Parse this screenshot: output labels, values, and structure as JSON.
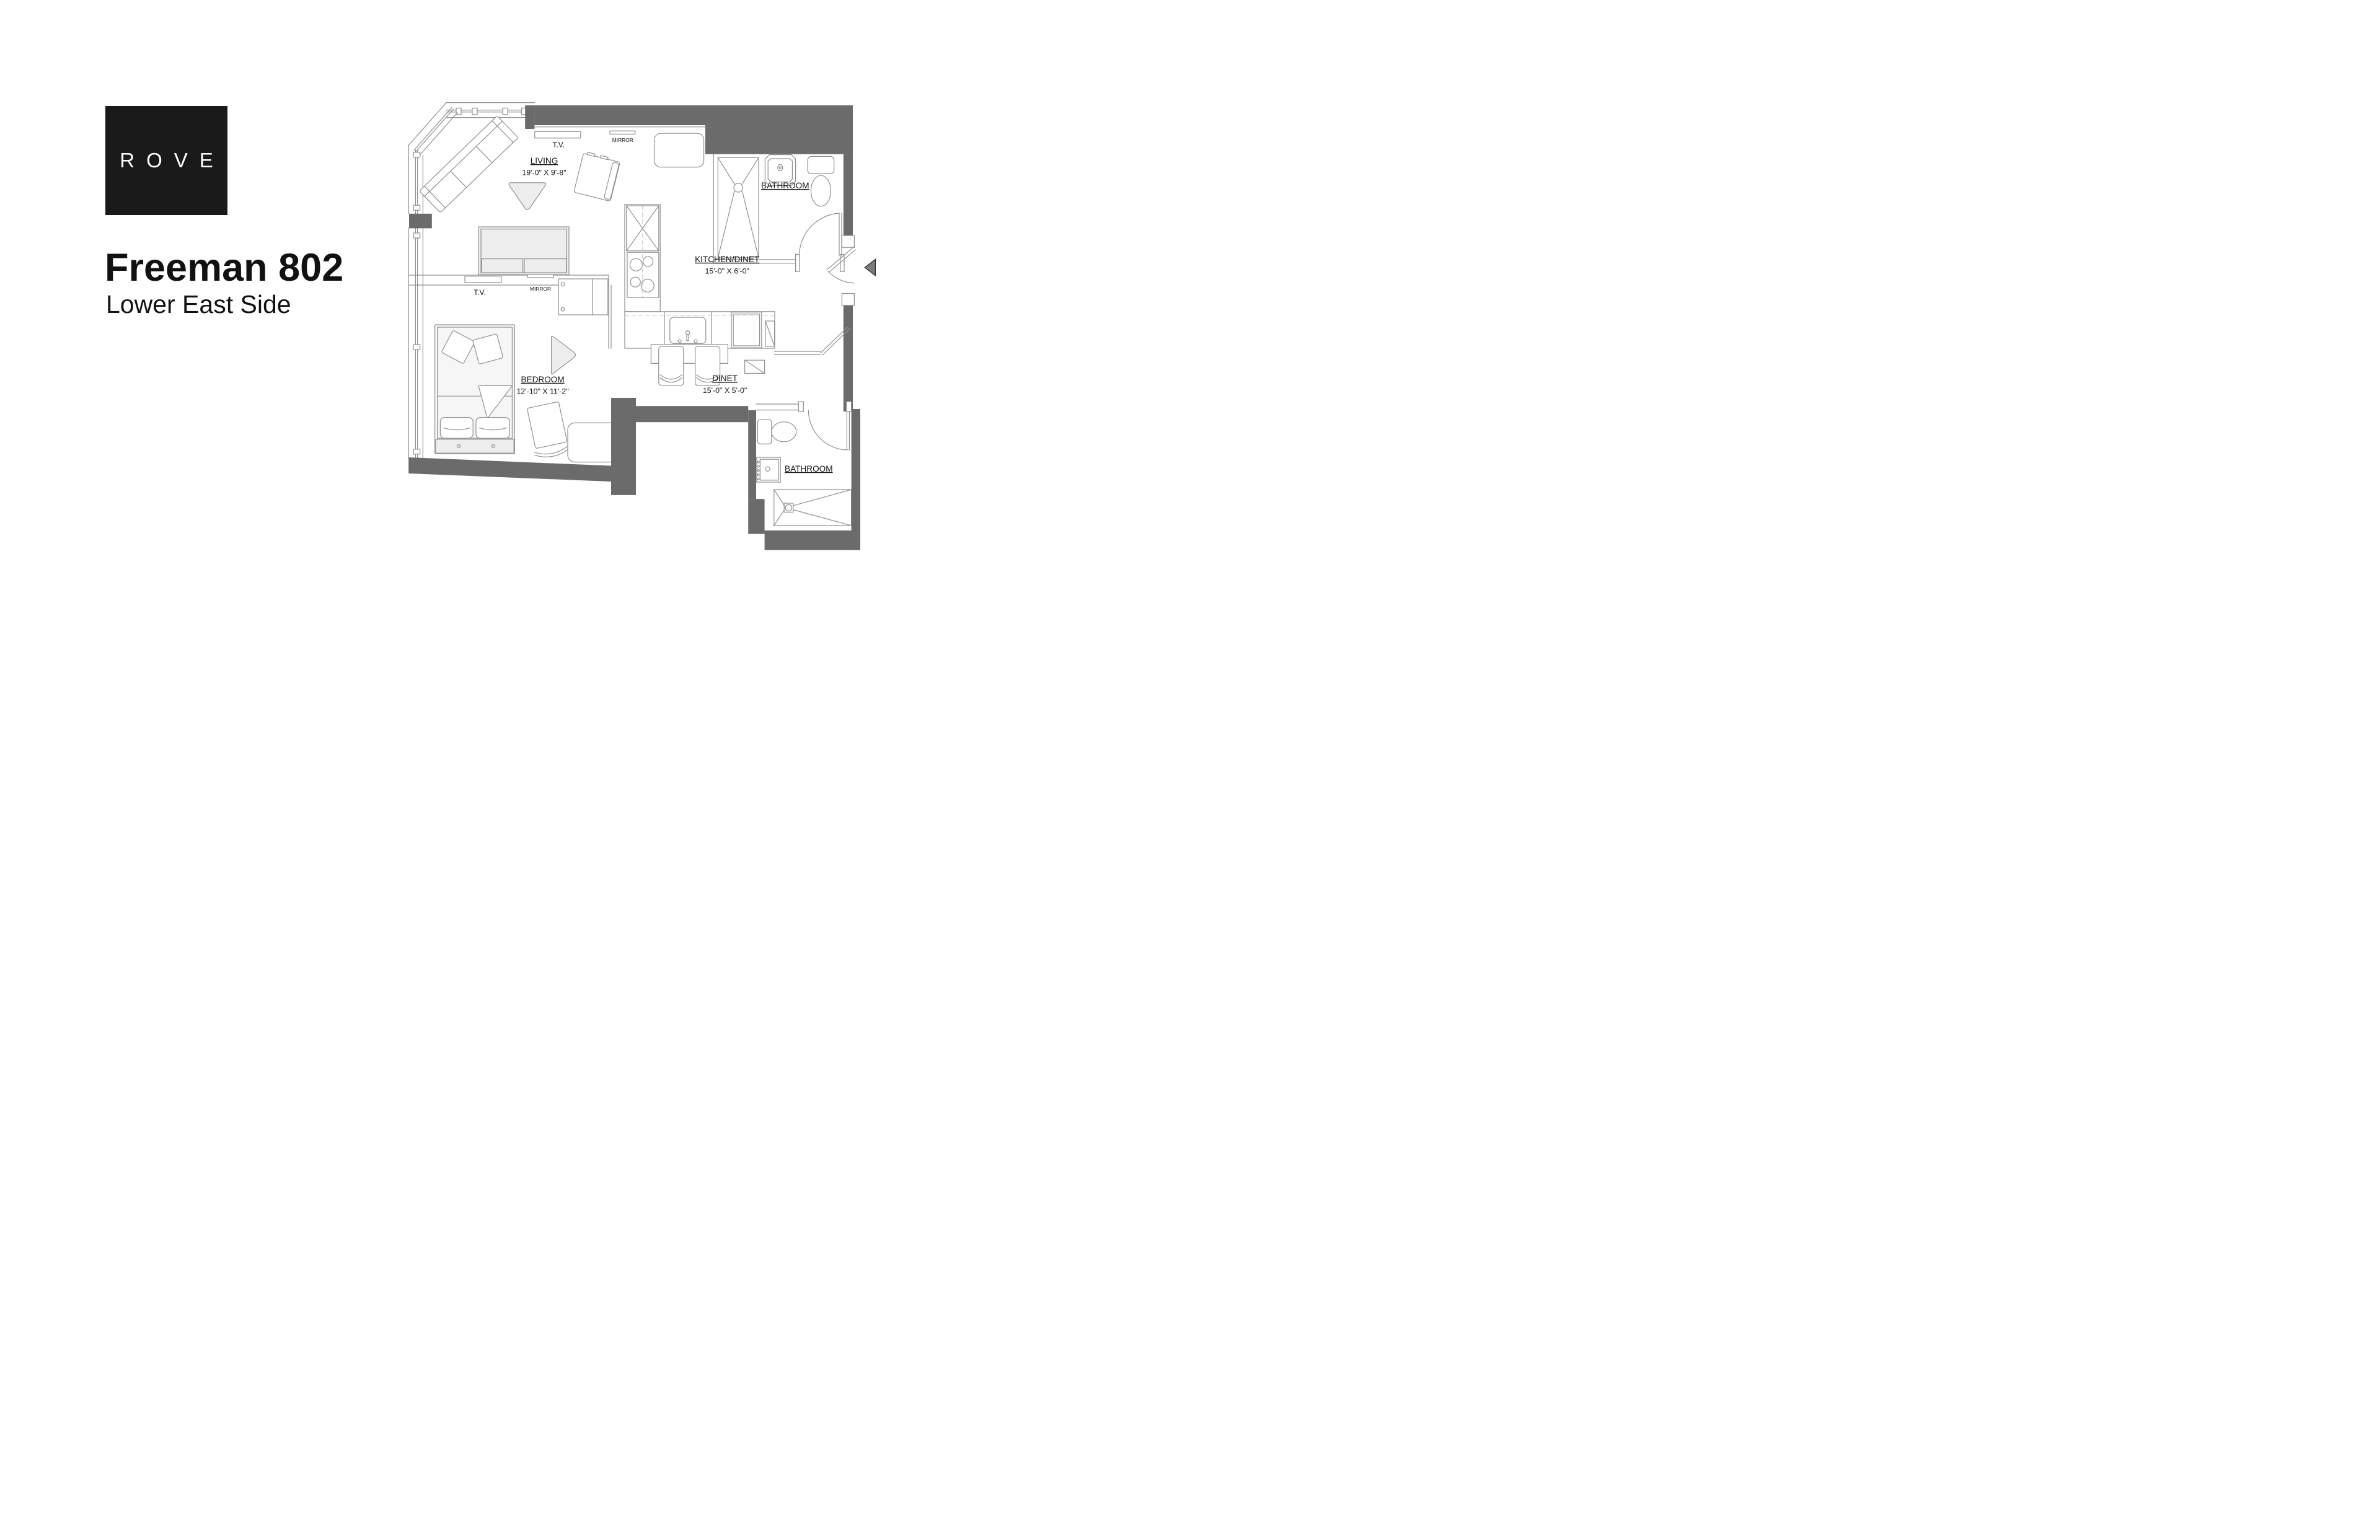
{
  "page": {
    "background": "#ffffff"
  },
  "brand": {
    "logo_text": "ROVE",
    "logo_bg": "#1a1a1a",
    "logo_fg": "#ffffff"
  },
  "listing": {
    "title": "Freeman 802",
    "subtitle": "Lower East Side",
    "text_color": "#111111"
  },
  "plan": {
    "wall_color": "#6b6b6b",
    "line_color": "#909090",
    "furniture_fill": "#ededed",
    "arrow_color": "#7a7a7a",
    "rooms": [
      {
        "id": "living",
        "name": "LIVING",
        "dims": "19'-0\" X 9'-8\""
      },
      {
        "id": "kitchen_dinet",
        "name": "KITCHEN/DINET",
        "dims": "15'-0\" X 6'-0\""
      },
      {
        "id": "bedroom",
        "name": "BEDROOM",
        "dims": "12'-10\" X 11'-2\""
      },
      {
        "id": "dinet",
        "name": "DINET",
        "dims": "15'-0\" X 5'-0\""
      },
      {
        "id": "bathroom_top",
        "name": "BATHROOM",
        "dims": ""
      },
      {
        "id": "bathroom_bottom",
        "name": "BATHROOM",
        "dims": ""
      }
    ],
    "fixtures": {
      "tv_living": "T.V.",
      "mirror_living": "MIRROR",
      "tv_bedroom": "T.V.",
      "mirror_bedroom": "MIRROR"
    }
  }
}
